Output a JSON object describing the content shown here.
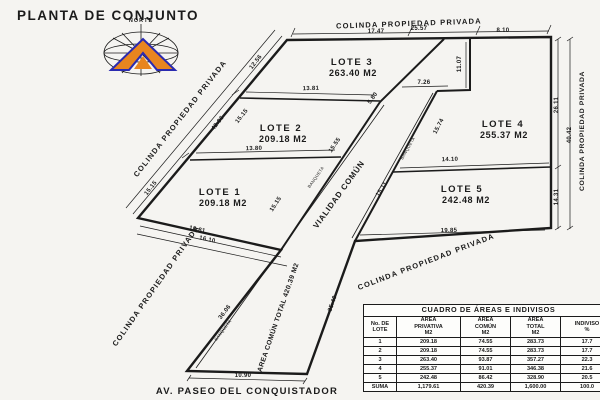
{
  "title": "PLANTA DE CONJUNTO",
  "compass": {
    "label": "NORTE"
  },
  "boundaries": {
    "top": "COLINDA PROPIEDAD PRIVADA",
    "left": "COLINDA PROPIEDAD PRIVADA",
    "right": "COLINDA PROPIEDAD PRIVADA",
    "lower_left": "COLINDA PROPIEDAD PRIVADA",
    "lower_right": "COLINDA PROPIEDAD PRIVADA"
  },
  "street": {
    "name": "AV. PASEO DEL CONQUISTADOR"
  },
  "road": {
    "label": "VIALIDAD COMÚN",
    "common_area": "AREA COMÚN TOTAL   420.39 M2",
    "sidewalk": "BANQUETA"
  },
  "lots": [
    {
      "name": "LOTE 1",
      "area": "209.18 M2"
    },
    {
      "name": "LOTE 2",
      "area": "209.18 M2"
    },
    {
      "name": "LOTE 3",
      "area": "263.40 M2"
    },
    {
      "name": "LOTE 4",
      "area": "255.37 M2"
    },
    {
      "name": "LOTE 5",
      "area": "242.48 M2"
    }
  ],
  "dimensions": {
    "top_seg1": "17.47",
    "top_seg2": "25.57",
    "top_seg3": "8.10",
    "left_seg1": "12.56",
    "left_seg2": "15.15",
    "left_seg3": "15.15",
    "left_total": "42.86",
    "lot1_road_edge": "15.15",
    "div_lot3_lot2": "13.81",
    "div_lot2_lot1": "13.80",
    "lot1_bottom_inner": "13.81",
    "lot1_bottom_outer": "16.10",
    "notch_diag": "5.80",
    "notch_top": "7.26",
    "lot4_left_vert": "11.07",
    "lot4_left_diag": "15.74",
    "road_left_upper": "15.55",
    "road_right_upper": "15.11",
    "div_lot4_lot5": "14.10",
    "lot5_bottom": "19.85",
    "right_seg1": "26.11",
    "right_seg2": "14.31",
    "right_total": "40.42",
    "road_left_lower": "36.06",
    "road_right_lower": "35.40",
    "street_mouth": "10.90"
  },
  "table": {
    "title": "CUADRO DE ÁREAS E INDIVISOS",
    "headers": [
      "No. DE\nLOTE",
      "ÁREA\nPRIVATIVA\nM2",
      "ÁREA\nCOMÚN\nM2",
      "ÁREA\nTOTAL\nM2",
      "INDIVISO\n%"
    ],
    "rows": [
      [
        "1",
        "209.18",
        "74.55",
        "283.73",
        "17.7"
      ],
      [
        "2",
        "209.18",
        "74.55",
        "283.73",
        "17.7"
      ],
      [
        "3",
        "263.40",
        "93.87",
        "357.27",
        "22.3"
      ],
      [
        "4",
        "255.37",
        "91.01",
        "346.38",
        "21.6"
      ],
      [
        "5",
        "242.48",
        "86.42",
        "328.90",
        "20.5"
      ],
      [
        "SUMA",
        "1,179.61",
        "420.39",
        "1,600.00",
        "100.0"
      ]
    ]
  },
  "colors": {
    "line": "#1b1b1b",
    "paper": "#f5f4f1",
    "compass_orange": "#e8851f",
    "compass_blue": "#2a2ab0"
  }
}
